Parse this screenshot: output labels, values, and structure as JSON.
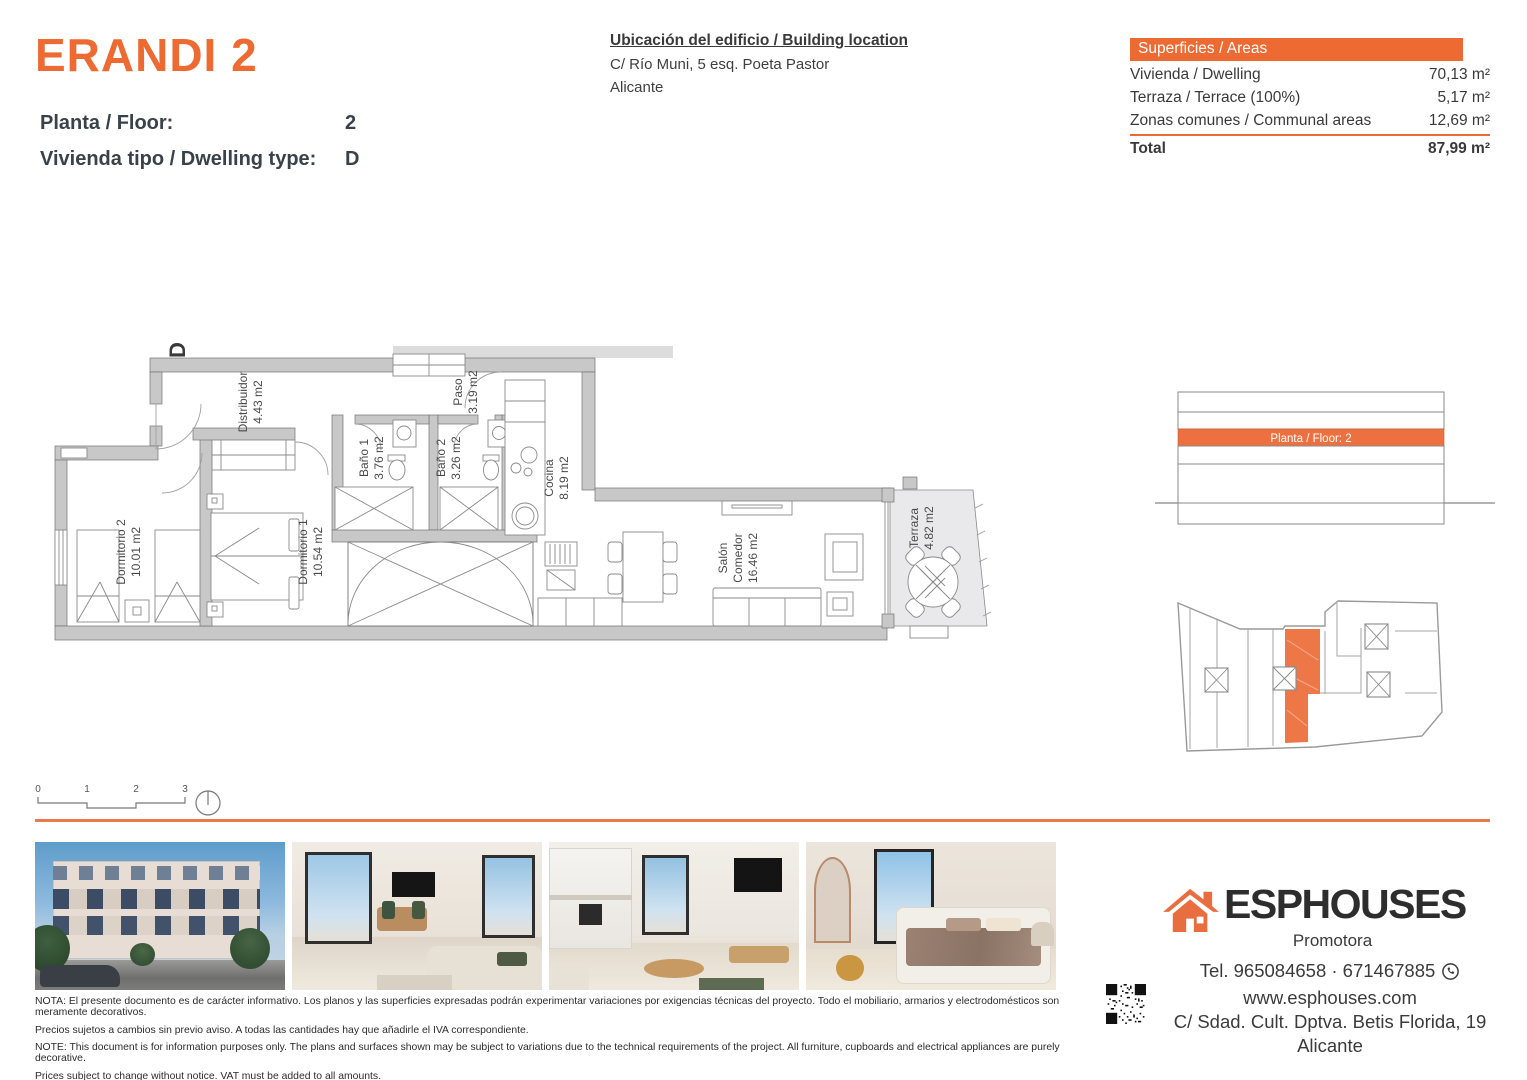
{
  "colors": {
    "accent": "#ed6b33",
    "accent_soft": "#ee7a49",
    "wall_gray": "#c8c8c8",
    "terrace_gray": "#e9e9ec"
  },
  "header": {
    "title": "ERANDI 2",
    "floor_label": "Planta / Floor:",
    "floor_value": "2",
    "dwelling_label": "Vivienda tipo / Dwelling type:",
    "dwelling_value": "D",
    "location_title": "Ubicación del edificio / Building location",
    "location_line1": "C/ Río Muni, 5 esq. Poeta Pastor",
    "location_line2": "Alicante"
  },
  "areas_table": {
    "header": "Superficies / Areas",
    "rows": [
      {
        "label": "Vivienda / Dwelling",
        "value": "70,13 m²"
      },
      {
        "label": "Terraza / Terrace (100%)",
        "value": "5,17 m²"
      },
      {
        "label": "Zonas comunes / Communal areas",
        "value": "12,69 m²"
      }
    ],
    "total_label": "Total",
    "total_value": "87,99 m²"
  },
  "floor_plan": {
    "marker": "D",
    "rooms": [
      {
        "name": "Distribuidor",
        "area": "4.43 m2"
      },
      {
        "name": "Paso",
        "area": "3.19 m2"
      },
      {
        "name": "Baño 1",
        "area": "3.76 m2"
      },
      {
        "name": "Baño 2",
        "area": "3.26 m2"
      },
      {
        "name": "Cocina",
        "area": "8.19 m2"
      },
      {
        "name": "Dormitorio 2",
        "area": "10.01 m2"
      },
      {
        "name": "Dormitorio 1",
        "area": "10.54 m2"
      },
      {
        "name": "Salón",
        "name2": "Comedor",
        "area": "16.46 m2"
      },
      {
        "name": "Terraza",
        "area": "4.82 m2"
      }
    ]
  },
  "elevation": {
    "label": "Planta / Floor: 2"
  },
  "scale_bar": {
    "ticks": [
      "0",
      "1",
      "2",
      "3"
    ]
  },
  "photos": [
    "building-exterior",
    "living-dining-room",
    "kitchen-living-room",
    "bedroom"
  ],
  "brand": {
    "name": "ESPHOUSES",
    "tagline": "Promotora",
    "phone": "Tel. 965084658 · 671467885",
    "website": "www.esphouses.com",
    "address_line1": "C/ Sdad. Cult. Dptva. Betis Florida, 19",
    "address_line2": "Alicante"
  },
  "legal": {
    "es_line1": "NOTA: El presente documento es de carácter informativo. Los planos y las superficies expresadas podrán experimentar variaciones por exigencias técnicas del proyecto. Todo el mobiliario, armarios y electrodomésticos son meramente decorativos.",
    "es_line2": "Precios sujetos a cambios sin previo aviso. A todas las cantidades hay que añadirle el IVA correspondiente.",
    "en_line1": "NOTE: This document is for information purposes only. The plans and surfaces shown may be subject to variations due to the technical requirements of the project. All furniture, cupboards and electrical appliances are purely decorative.",
    "en_line2": "Prices subject to change without notice. VAT must be added to all amounts."
  }
}
